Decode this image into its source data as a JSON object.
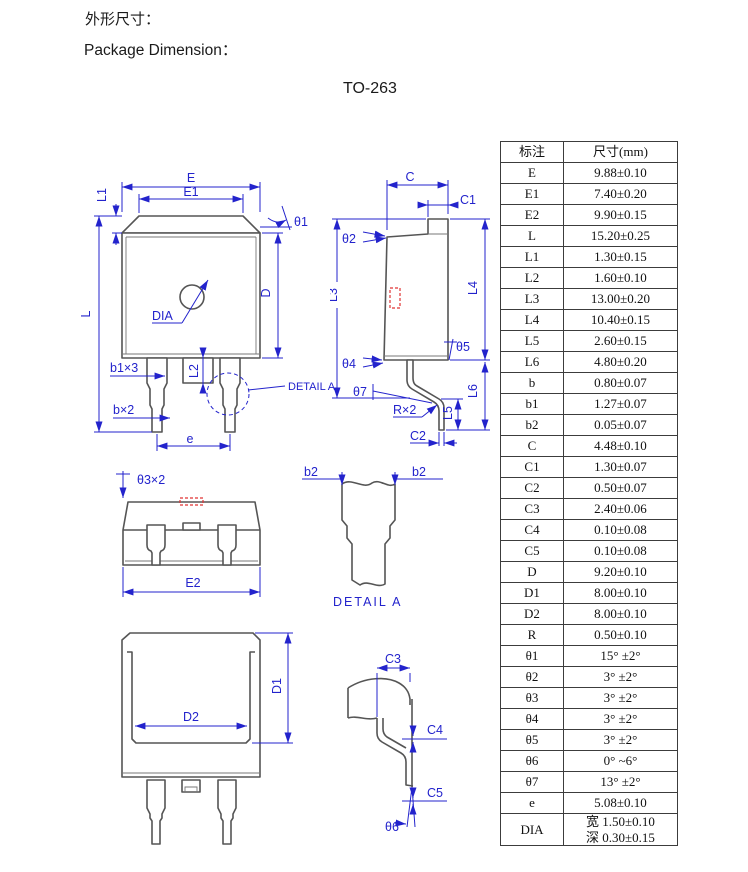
{
  "page": {
    "title_cn": "外形尺寸：",
    "title_en": "Package Dimension：",
    "package_name": "TO-263"
  },
  "colors": {
    "dimension_blue": "#2323cc",
    "outline_gray": "#555555",
    "highlight_red": "#e03333",
    "table_border": "#3c3c3c"
  },
  "table": {
    "headers": [
      "标注",
      "尺寸(mm)"
    ],
    "rows": [
      {
        "label": "E",
        "value": "9.88±0.10"
      },
      {
        "label": "E1",
        "value": "7.40±0.20"
      },
      {
        "label": "E2",
        "value": "9.90±0.15"
      },
      {
        "label": "L",
        "value": "15.20±0.25"
      },
      {
        "label": "L1",
        "value": "1.30±0.15"
      },
      {
        "label": "L2",
        "value": "1.60±0.10"
      },
      {
        "label": "L3",
        "value": "13.00±0.20"
      },
      {
        "label": "L4",
        "value": "10.40±0.15"
      },
      {
        "label": "L5",
        "value": "2.60±0.15"
      },
      {
        "label": "L6",
        "value": "4.80±0.20"
      },
      {
        "label": "b",
        "value": "0.80±0.07"
      },
      {
        "label": "b1",
        "value": "1.27±0.07"
      },
      {
        "label": "b2",
        "value": "0.05±0.07"
      },
      {
        "label": "C",
        "value": "4.48±0.10"
      },
      {
        "label": "C1",
        "value": "1.30±0.07"
      },
      {
        "label": "C2",
        "value": "0.50±0.07"
      },
      {
        "label": "C3",
        "value": "2.40±0.06"
      },
      {
        "label": "C4",
        "value": "0.10±0.08"
      },
      {
        "label": "C5",
        "value": "0.10±0.08"
      },
      {
        "label": "D",
        "value": "9.20±0.10"
      },
      {
        "label": "D1",
        "value": "8.00±0.10"
      },
      {
        "label": "D2",
        "value": "8.00±0.10"
      },
      {
        "label": "R",
        "value": "0.50±0.10"
      },
      {
        "label": "θ1",
        "value": "15° ±2°"
      },
      {
        "label": "θ2",
        "value": "3° ±2°"
      },
      {
        "label": "θ3",
        "value": "3° ±2°"
      },
      {
        "label": "θ4",
        "value": "3° ±2°"
      },
      {
        "label": "θ5",
        "value": "3° ±2°"
      },
      {
        "label": "θ6",
        "value": "0° ~6°"
      },
      {
        "label": "θ7",
        "value": "13° ±2°"
      },
      {
        "label": "e",
        "value": "5.08±0.10"
      },
      {
        "label": "DIA",
        "value": "宽 1.50±0.10\n深 0.30±0.15"
      }
    ]
  },
  "drawings": {
    "front_view": {
      "labels": {
        "E": "E",
        "E1": "E1",
        "L1": "L1",
        "theta1": "θ1",
        "L": "L",
        "D": "D",
        "DIA": "DIA",
        "b1x3": "b1×3",
        "bx2": "b×2",
        "L2": "L2",
        "e": "e",
        "detail_a": "DETAIL A"
      }
    },
    "side_view": {
      "labels": {
        "C": "C",
        "C1": "C1",
        "theta2": "θ2",
        "L3": "L3",
        "L4": "L4",
        "theta4": "θ4",
        "theta5": "θ5",
        "theta7": "θ7",
        "Rx2": "R×2",
        "L5": "L5",
        "L6": "L6",
        "C2": "C2"
      }
    },
    "top_view": {
      "labels": {
        "theta3x2": "θ3×2",
        "E2": "E2"
      }
    },
    "detail_a_view": {
      "labels": {
        "b2_left": "b2",
        "b2_right": "b2",
        "caption": "DETAIL A"
      }
    },
    "bottom_view": {
      "labels": {
        "D1": "D1",
        "D2": "D2"
      }
    },
    "lead_detail_view": {
      "labels": {
        "C3": "C3",
        "C4": "C4",
        "C5": "C5",
        "theta6": "θ6"
      }
    }
  }
}
